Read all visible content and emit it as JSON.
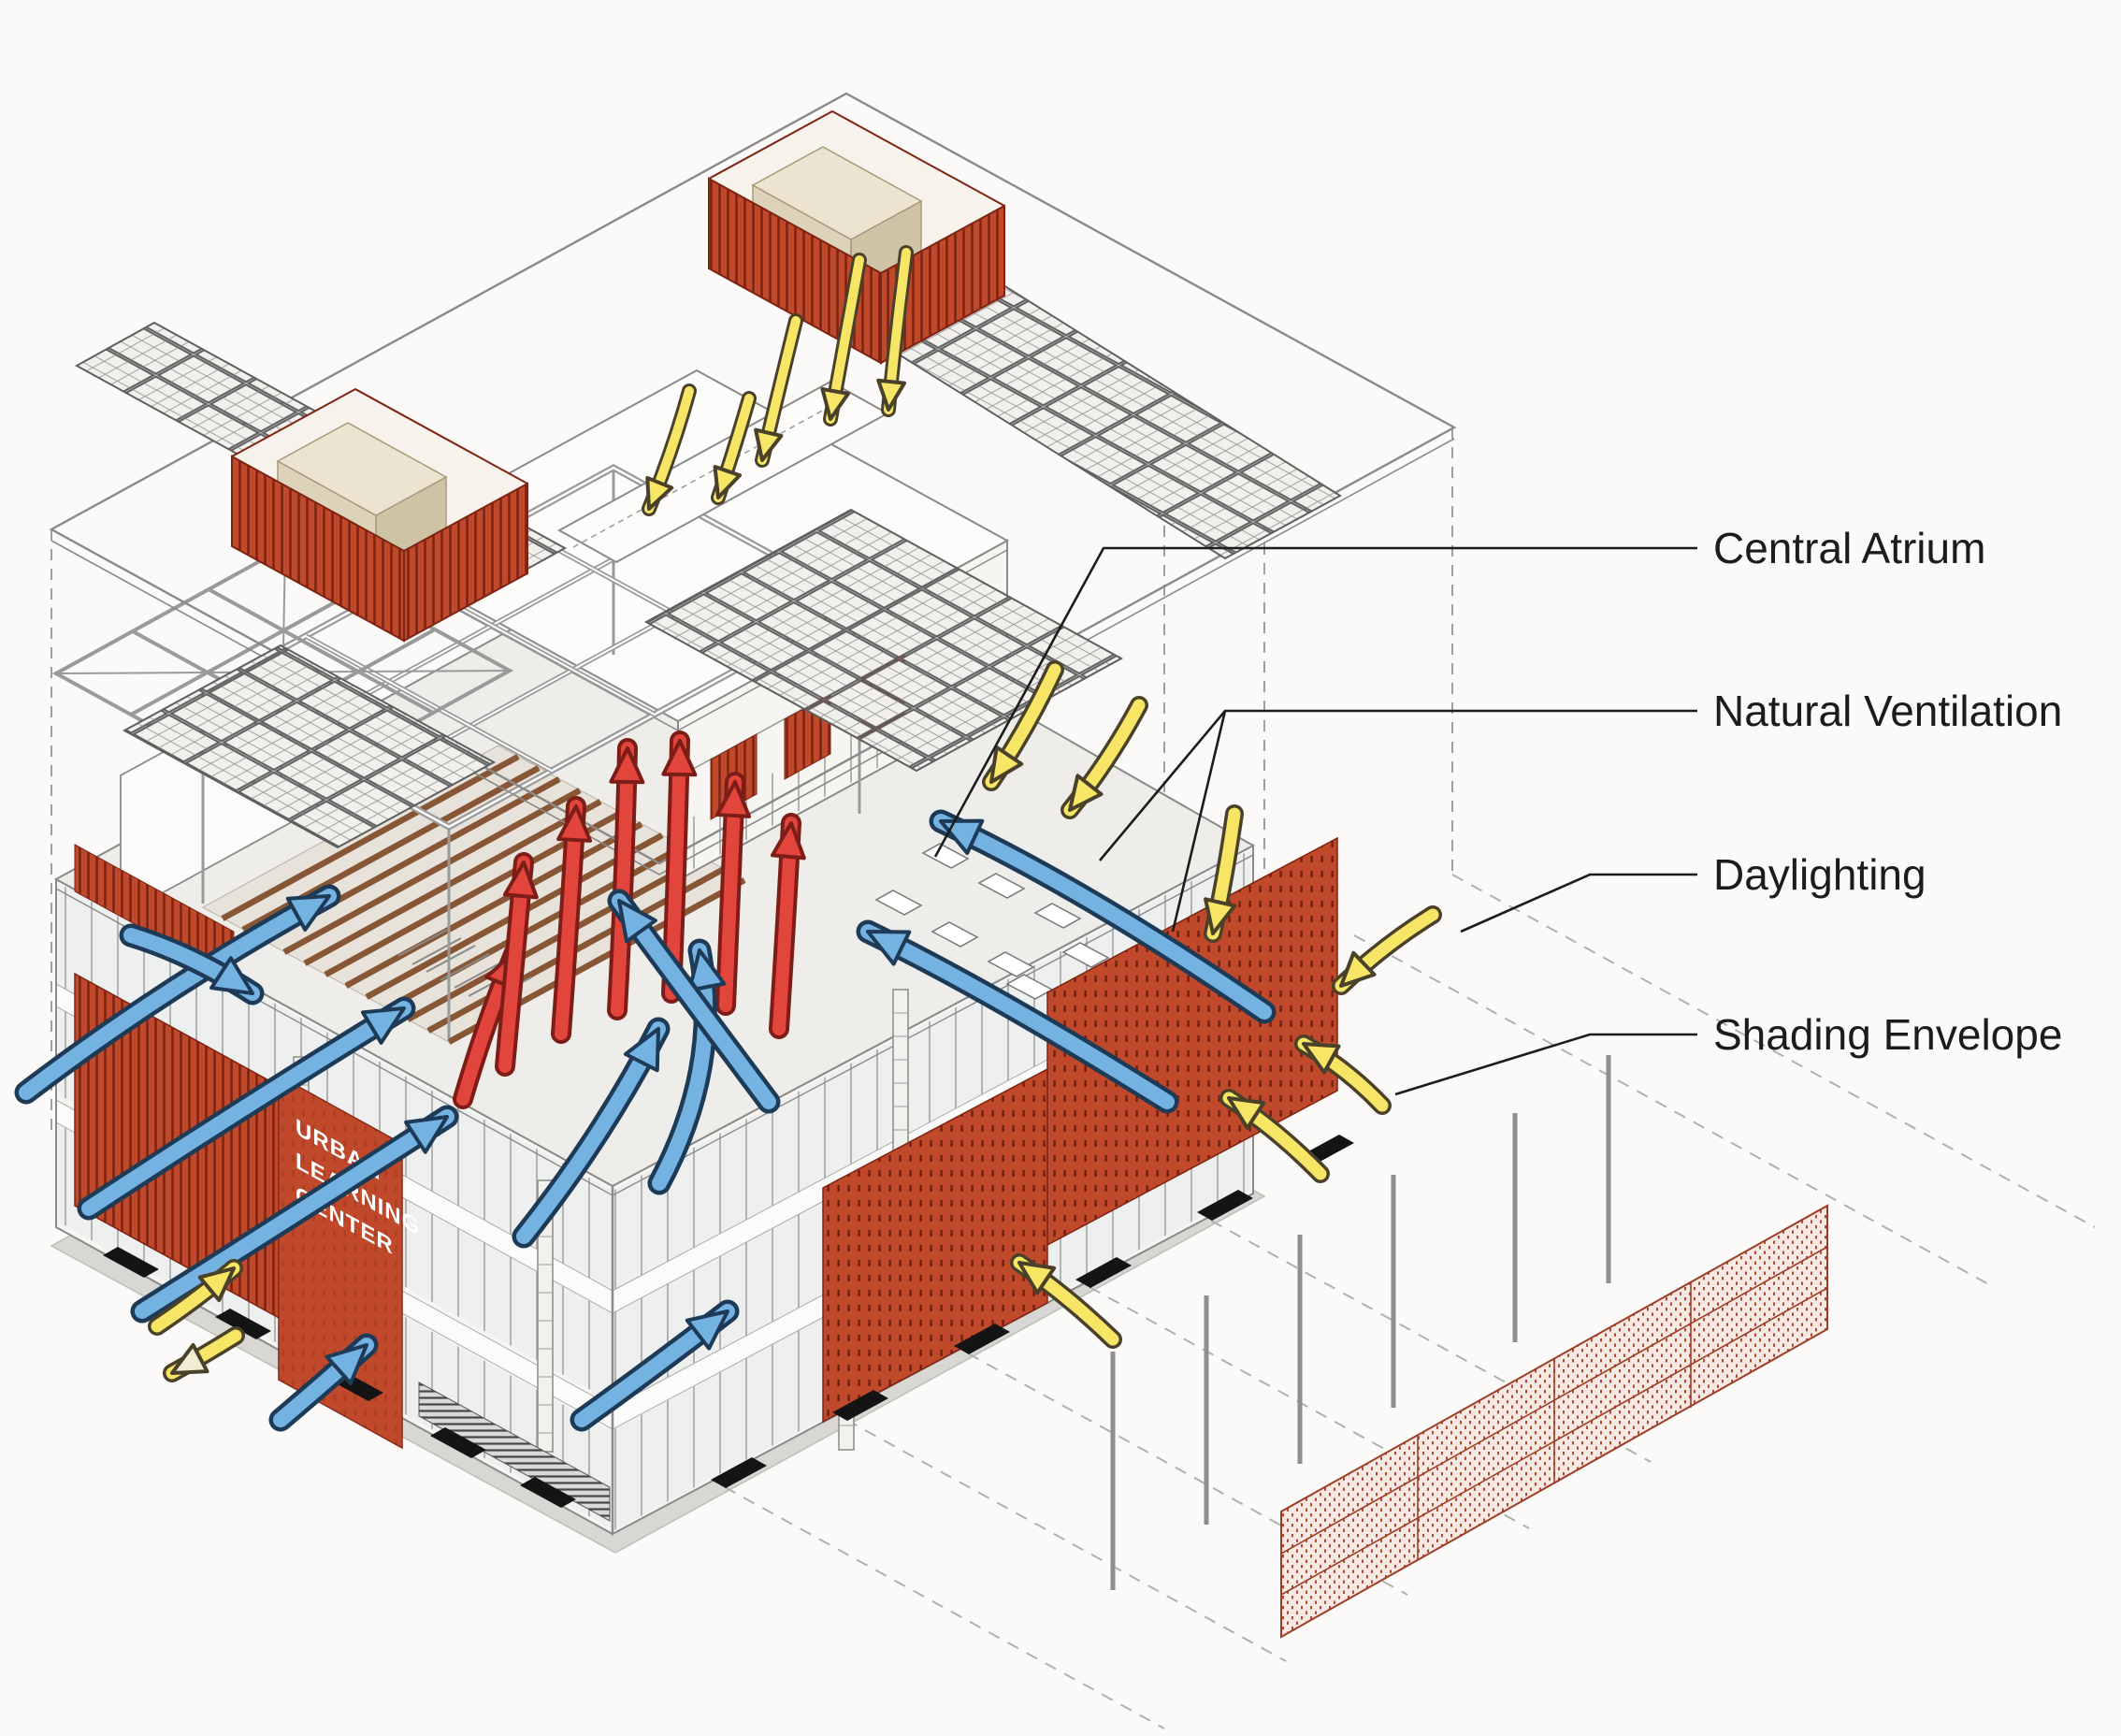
{
  "diagram": {
    "type": "exploded-axonometric-sustainability-diagram",
    "subject": "Urban Learning Center building systems"
  },
  "callouts": [
    {
      "label": "Central Atrium"
    },
    {
      "label": "Natural Ventilation"
    },
    {
      "label": "Daylighting"
    },
    {
      "label": "Shading Envelope"
    }
  ],
  "building_sign": {
    "line1": "URBAN",
    "line2": "LEARNING",
    "line3": "CENTER"
  },
  "colors": {
    "bg": "#fbfaf8",
    "screen_red": "#c0492b",
    "screen_red_dark": "#7e2413",
    "sun_yellow": "#f7e566",
    "sun_outline": "#4a412a",
    "air_blue": "#74b2e2",
    "air_outline": "#1d3a57",
    "heat_red": "#e2453c",
    "heat_outline": "#7d1d18",
    "wood_brown": "#875635",
    "line_gray": "#8a8a8a",
    "ground_gray": "#d8d7d4",
    "label_ink": "#1c1c1c",
    "equip_beige": "#ece4d0",
    "mesh_red": "#b04a30",
    "pale_head": "#f3ecd4"
  }
}
